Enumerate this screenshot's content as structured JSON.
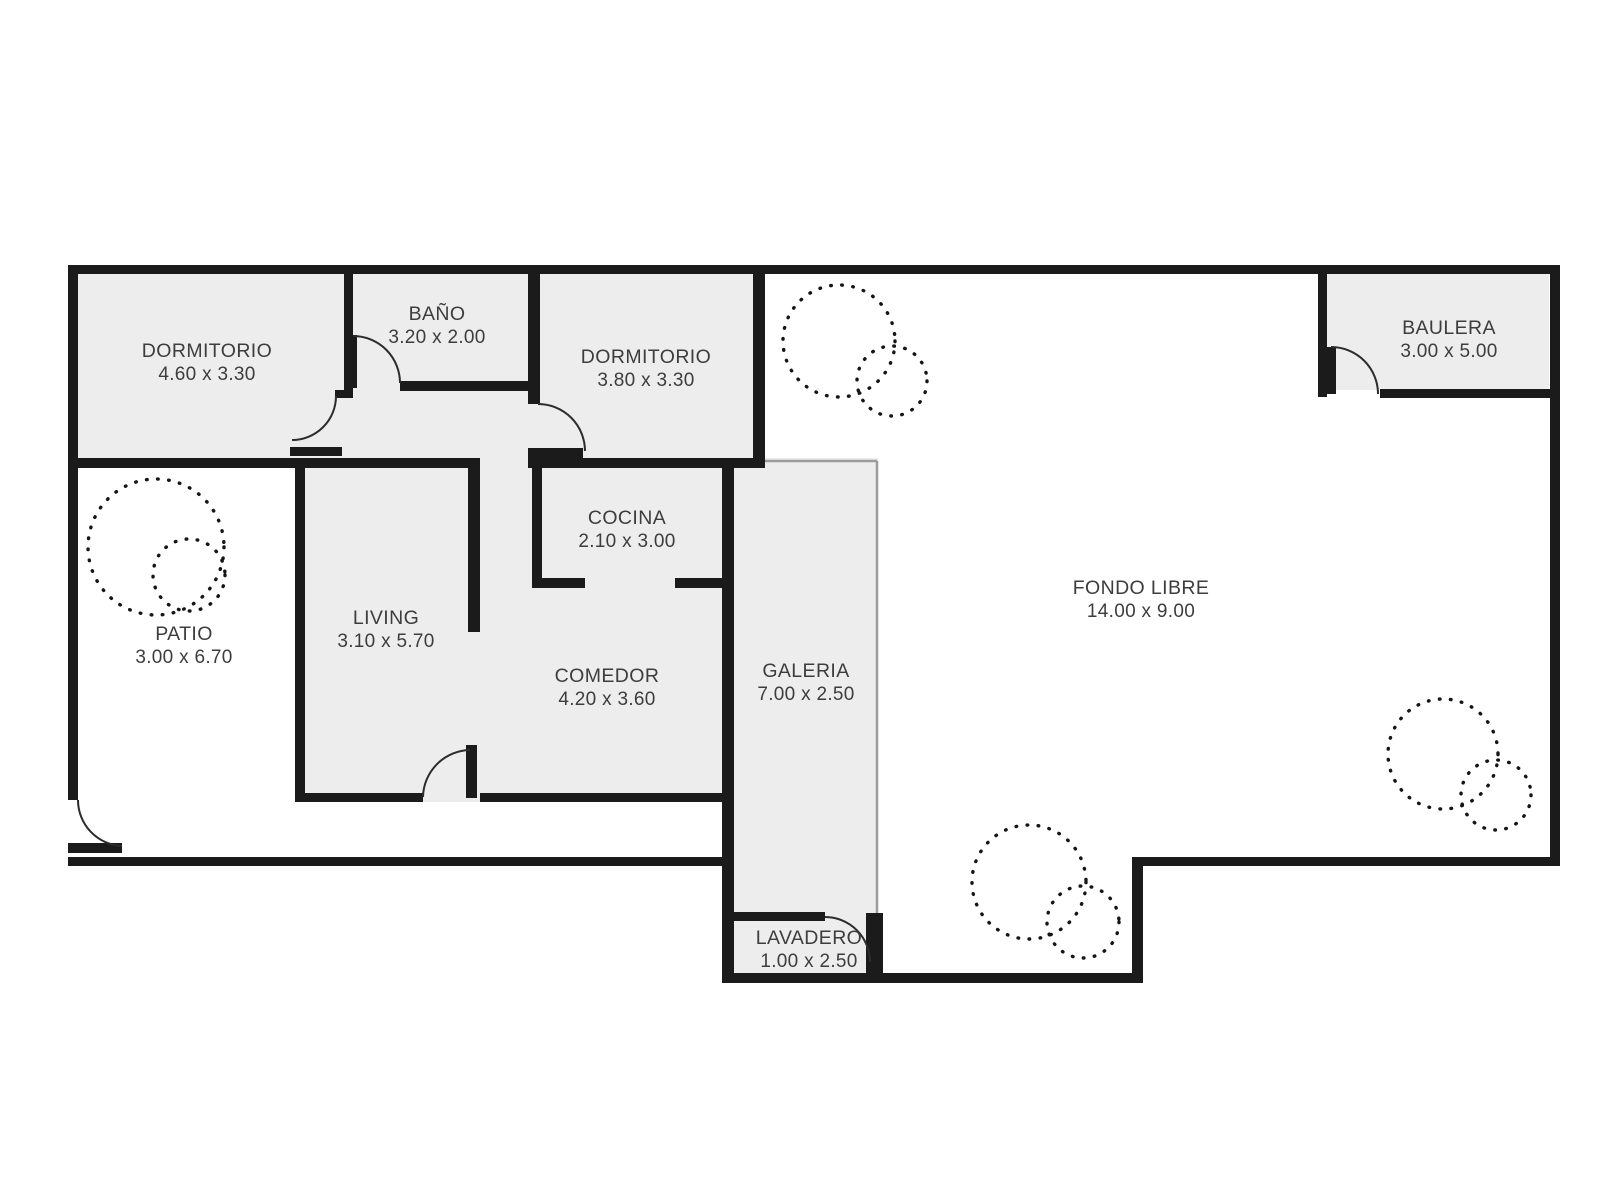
{
  "plan": {
    "canvas": {
      "width": 1600,
      "height": 1200,
      "background": "#ffffff"
    },
    "colors": {
      "wall": "#1b1b1b",
      "room_fill": "#ededed",
      "thin_edge": "#9c9c9c",
      "door_arc": "#2c2c2c",
      "tree_dot": "#151515",
      "text": "#3d3d3d"
    },
    "rooms": [
      {
        "id": "dormitorio-1",
        "name": "DORMITORIO",
        "dims": "4.60 x 3.30",
        "label_x": 207,
        "label_y": 350
      },
      {
        "id": "bano",
        "name": "BAÑO",
        "dims": "3.20 x 2.00",
        "label_x": 437,
        "label_y": 313
      },
      {
        "id": "dormitorio-2",
        "name": "DORMITORIO",
        "dims": "3.80 x 3.30",
        "label_x": 646,
        "label_y": 356
      },
      {
        "id": "baulera",
        "name": "BAULERA",
        "dims": "3.00 x 5.00",
        "label_x": 1449,
        "label_y": 327
      },
      {
        "id": "cocina",
        "name": "COCINA",
        "dims": "2.10 x 3.00",
        "label_x": 627,
        "label_y": 517
      },
      {
        "id": "living",
        "name": "LIVING",
        "dims": "3.10 x 5.70",
        "label_x": 386,
        "label_y": 617
      },
      {
        "id": "patio",
        "name": "PATIO",
        "dims": "3.00 x 6.70",
        "label_x": 184,
        "label_y": 633
      },
      {
        "id": "comedor",
        "name": "COMEDOR",
        "dims": "4.20 x 3.60",
        "label_x": 607,
        "label_y": 675
      },
      {
        "id": "galeria",
        "name": "GALERIA",
        "dims": "7.00 x 2.50",
        "label_x": 806,
        "label_y": 670
      },
      {
        "id": "fondo-libre",
        "name": "FONDO LIBRE",
        "dims": "14.00 x 9.00",
        "label_x": 1141,
        "label_y": 587
      },
      {
        "id": "lavadero",
        "name": "LAVADERO",
        "dims": "1.00 x 2.50",
        "label_x": 809,
        "label_y": 937
      }
    ],
    "fills": [
      {
        "name": "house-interior-fill",
        "type": "polygon",
        "points": "68,265 765,265 765,468 733,468 733,802 295,802 295,458 68,458"
      },
      {
        "name": "galeria-fill",
        "type": "rect",
        "rect": [
          733,
          458,
          145,
          462
        ]
      },
      {
        "name": "lavadero-fill",
        "type": "rect",
        "rect": [
          728,
          920,
          140,
          57
        ]
      },
      {
        "name": "baulera-fill",
        "type": "rect",
        "rect": [
          1326,
          273,
          223,
          117
        ]
      }
    ],
    "edges": [
      {
        "name": "galeria-top-edge",
        "line": [
          735,
          461,
          877,
          461
        ]
      },
      {
        "name": "galeria-right-edge",
        "line": [
          877,
          461,
          877,
          913
        ]
      }
    ],
    "walls": [
      {
        "name": "outer-top-wall",
        "rect": [
          68,
          265,
          1492,
          9
        ]
      },
      {
        "name": "outer-left-wall",
        "rect": [
          68,
          265,
          10,
          535
        ]
      },
      {
        "name": "outer-right-wall",
        "rect": [
          1550,
          265,
          10,
          601
        ]
      },
      {
        "name": "entry-sill-wall",
        "rect": [
          68,
          843,
          54,
          10
        ]
      },
      {
        "name": "boundary-bottom-left-wall",
        "rect": [
          68,
          857,
          666,
          9
        ]
      },
      {
        "name": "corridor-left-wall",
        "rect": [
          722,
          458,
          12,
          525
        ]
      },
      {
        "name": "boundary-notch-bottom-wall",
        "rect": [
          722,
          973,
          421,
          10
        ]
      },
      {
        "name": "boundary-step-wall",
        "rect": [
          1132,
          857,
          11,
          126
        ]
      },
      {
        "name": "boundary-bottom-right-wall",
        "rect": [
          1132,
          857,
          428,
          9
        ]
      },
      {
        "name": "lavadero-top-wall",
        "rect": [
          734,
          912,
          91,
          9
        ]
      },
      {
        "name": "lavadero-right-jamb-wall",
        "rect": [
          866,
          913,
          17,
          70
        ]
      },
      {
        "name": "dorm1-living-wall",
        "rect": [
          68,
          458,
          410,
          10
        ]
      },
      {
        "name": "dorm1-bano-divider-wall",
        "rect": [
          344,
          265,
          9,
          125
        ]
      },
      {
        "name": "dorm1-divider-stub-wall",
        "rect": [
          335,
          390,
          18,
          8
        ]
      },
      {
        "name": "dorm1-door-sill-wall",
        "rect": [
          290,
          447,
          52,
          9
        ]
      },
      {
        "name": "bano-door-leaf",
        "rect": [
          349,
          335,
          8,
          53
        ]
      },
      {
        "name": "bano-bottom-wall",
        "rect": [
          400,
          381,
          133,
          10
        ]
      },
      {
        "name": "bano-dorm2-divider-wall",
        "rect": [
          528,
          265,
          12,
          139
        ]
      },
      {
        "name": "dorm2-door-sill-wall",
        "rect": [
          528,
          448,
          55,
          10
        ]
      },
      {
        "name": "dorm2-bottom-cocina-top-wall",
        "rect": [
          528,
          458,
          234,
          10
        ]
      },
      {
        "name": "dorm2-right-wall",
        "rect": [
          753,
          265,
          12,
          203
        ]
      },
      {
        "name": "living-left-wall",
        "rect": [
          295,
          458,
          10,
          344
        ]
      },
      {
        "name": "living-right-wall",
        "rect": [
          468,
          458,
          12,
          174
        ]
      },
      {
        "name": "comedor-door-leaf",
        "rect": [
          466,
          745,
          11,
          53
        ]
      },
      {
        "name": "living-bottom-wall",
        "rect": [
          295,
          793,
          128,
          9
        ]
      },
      {
        "name": "comedor-bottom-wall",
        "rect": [
          480,
          793,
          253,
          9
        ]
      },
      {
        "name": "cocina-left-wall",
        "rect": [
          532,
          458,
          10,
          130
        ]
      },
      {
        "name": "cocina-bottom-left-wall",
        "rect": [
          532,
          578,
          53,
          10
        ]
      },
      {
        "name": "cocina-bottom-right-wall",
        "rect": [
          675,
          578,
          58,
          10
        ]
      },
      {
        "name": "baulera-left-wall",
        "rect": [
          1318,
          265,
          9,
          132
        ]
      },
      {
        "name": "baulera-bottom-wall",
        "rect": [
          1380,
          389,
          180,
          9
        ]
      },
      {
        "name": "baulera-door-leaf",
        "rect": [
          1327,
          347,
          9,
          47
        ]
      }
    ],
    "doors": [
      {
        "name": "entry-door-arc",
        "path": "M78,800 A46,46 0 0 0 122,846"
      },
      {
        "name": "dorm1-door-arc",
        "path": "M336,396 A44,44 0 0 1 292,440"
      },
      {
        "name": "bano-door-arc",
        "path": "M353,336 A47,47 0 0 1 400,383"
      },
      {
        "name": "dorm2-door-arc",
        "path": "M538,404 A47,47 0 0 1 585,451"
      },
      {
        "name": "comedor-door-arc",
        "path": "M470,750 A48,48 0 0 0 423,797"
      },
      {
        "name": "lavadero-door-arc",
        "path": "M825,917 A45,45 0 0 1 870,962"
      },
      {
        "name": "baulera-door-arc",
        "path": "M1331,347 A47,47 0 0 1 1378,394"
      }
    ],
    "trees": [
      {
        "name": "tree-symbol-patio",
        "circles": [
          [
            156,
            547,
            68
          ],
          [
            189,
            575,
            36
          ]
        ]
      },
      {
        "name": "tree-symbol-fondo-upper",
        "circles": [
          [
            839,
            341,
            56
          ],
          [
            892,
            381,
            35
          ]
        ]
      },
      {
        "name": "tree-symbol-fondo-lower",
        "circles": [
          [
            1029,
            882,
            57
          ],
          [
            1083,
            922,
            36
          ]
        ]
      },
      {
        "name": "tree-symbol-fondo-right",
        "circles": [
          [
            1443,
            754,
            55
          ],
          [
            1496,
            795,
            35
          ]
        ]
      }
    ]
  }
}
